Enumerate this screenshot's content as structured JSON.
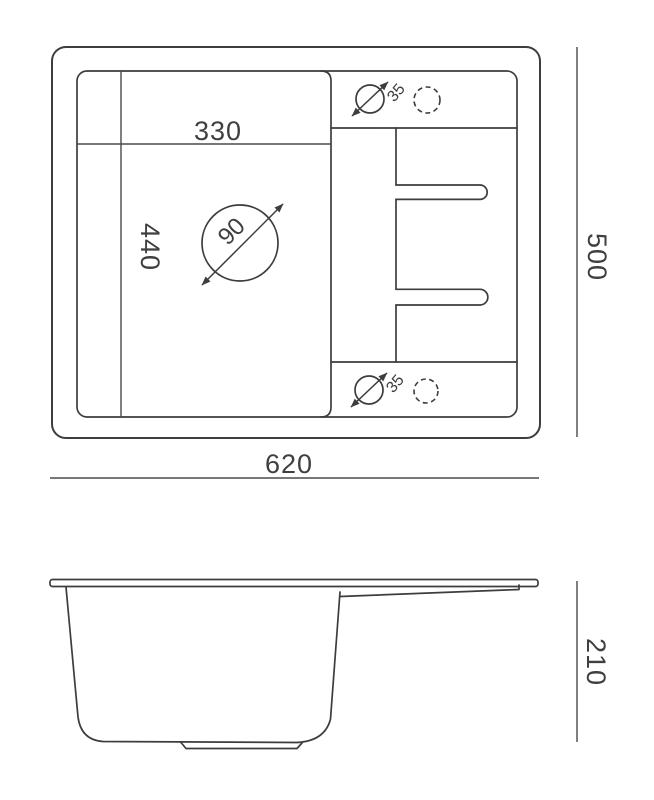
{
  "drawing": {
    "kind": "sink-technical-drawing",
    "colors": {
      "background": "#ffffff",
      "outline": "#3d3d3d",
      "dimension_line": "#4a4a4a",
      "text": "#3f3f3f"
    },
    "top_view": {
      "bowl_width": "330",
      "bowl_depth": "440",
      "drain_diameter": "90",
      "tap_hole_diameter_top": "35",
      "tap_hole_diameter_bottom": "35",
      "overall_width": "620",
      "overall_depth": "500"
    },
    "side_view": {
      "overall_height": "210"
    }
  }
}
